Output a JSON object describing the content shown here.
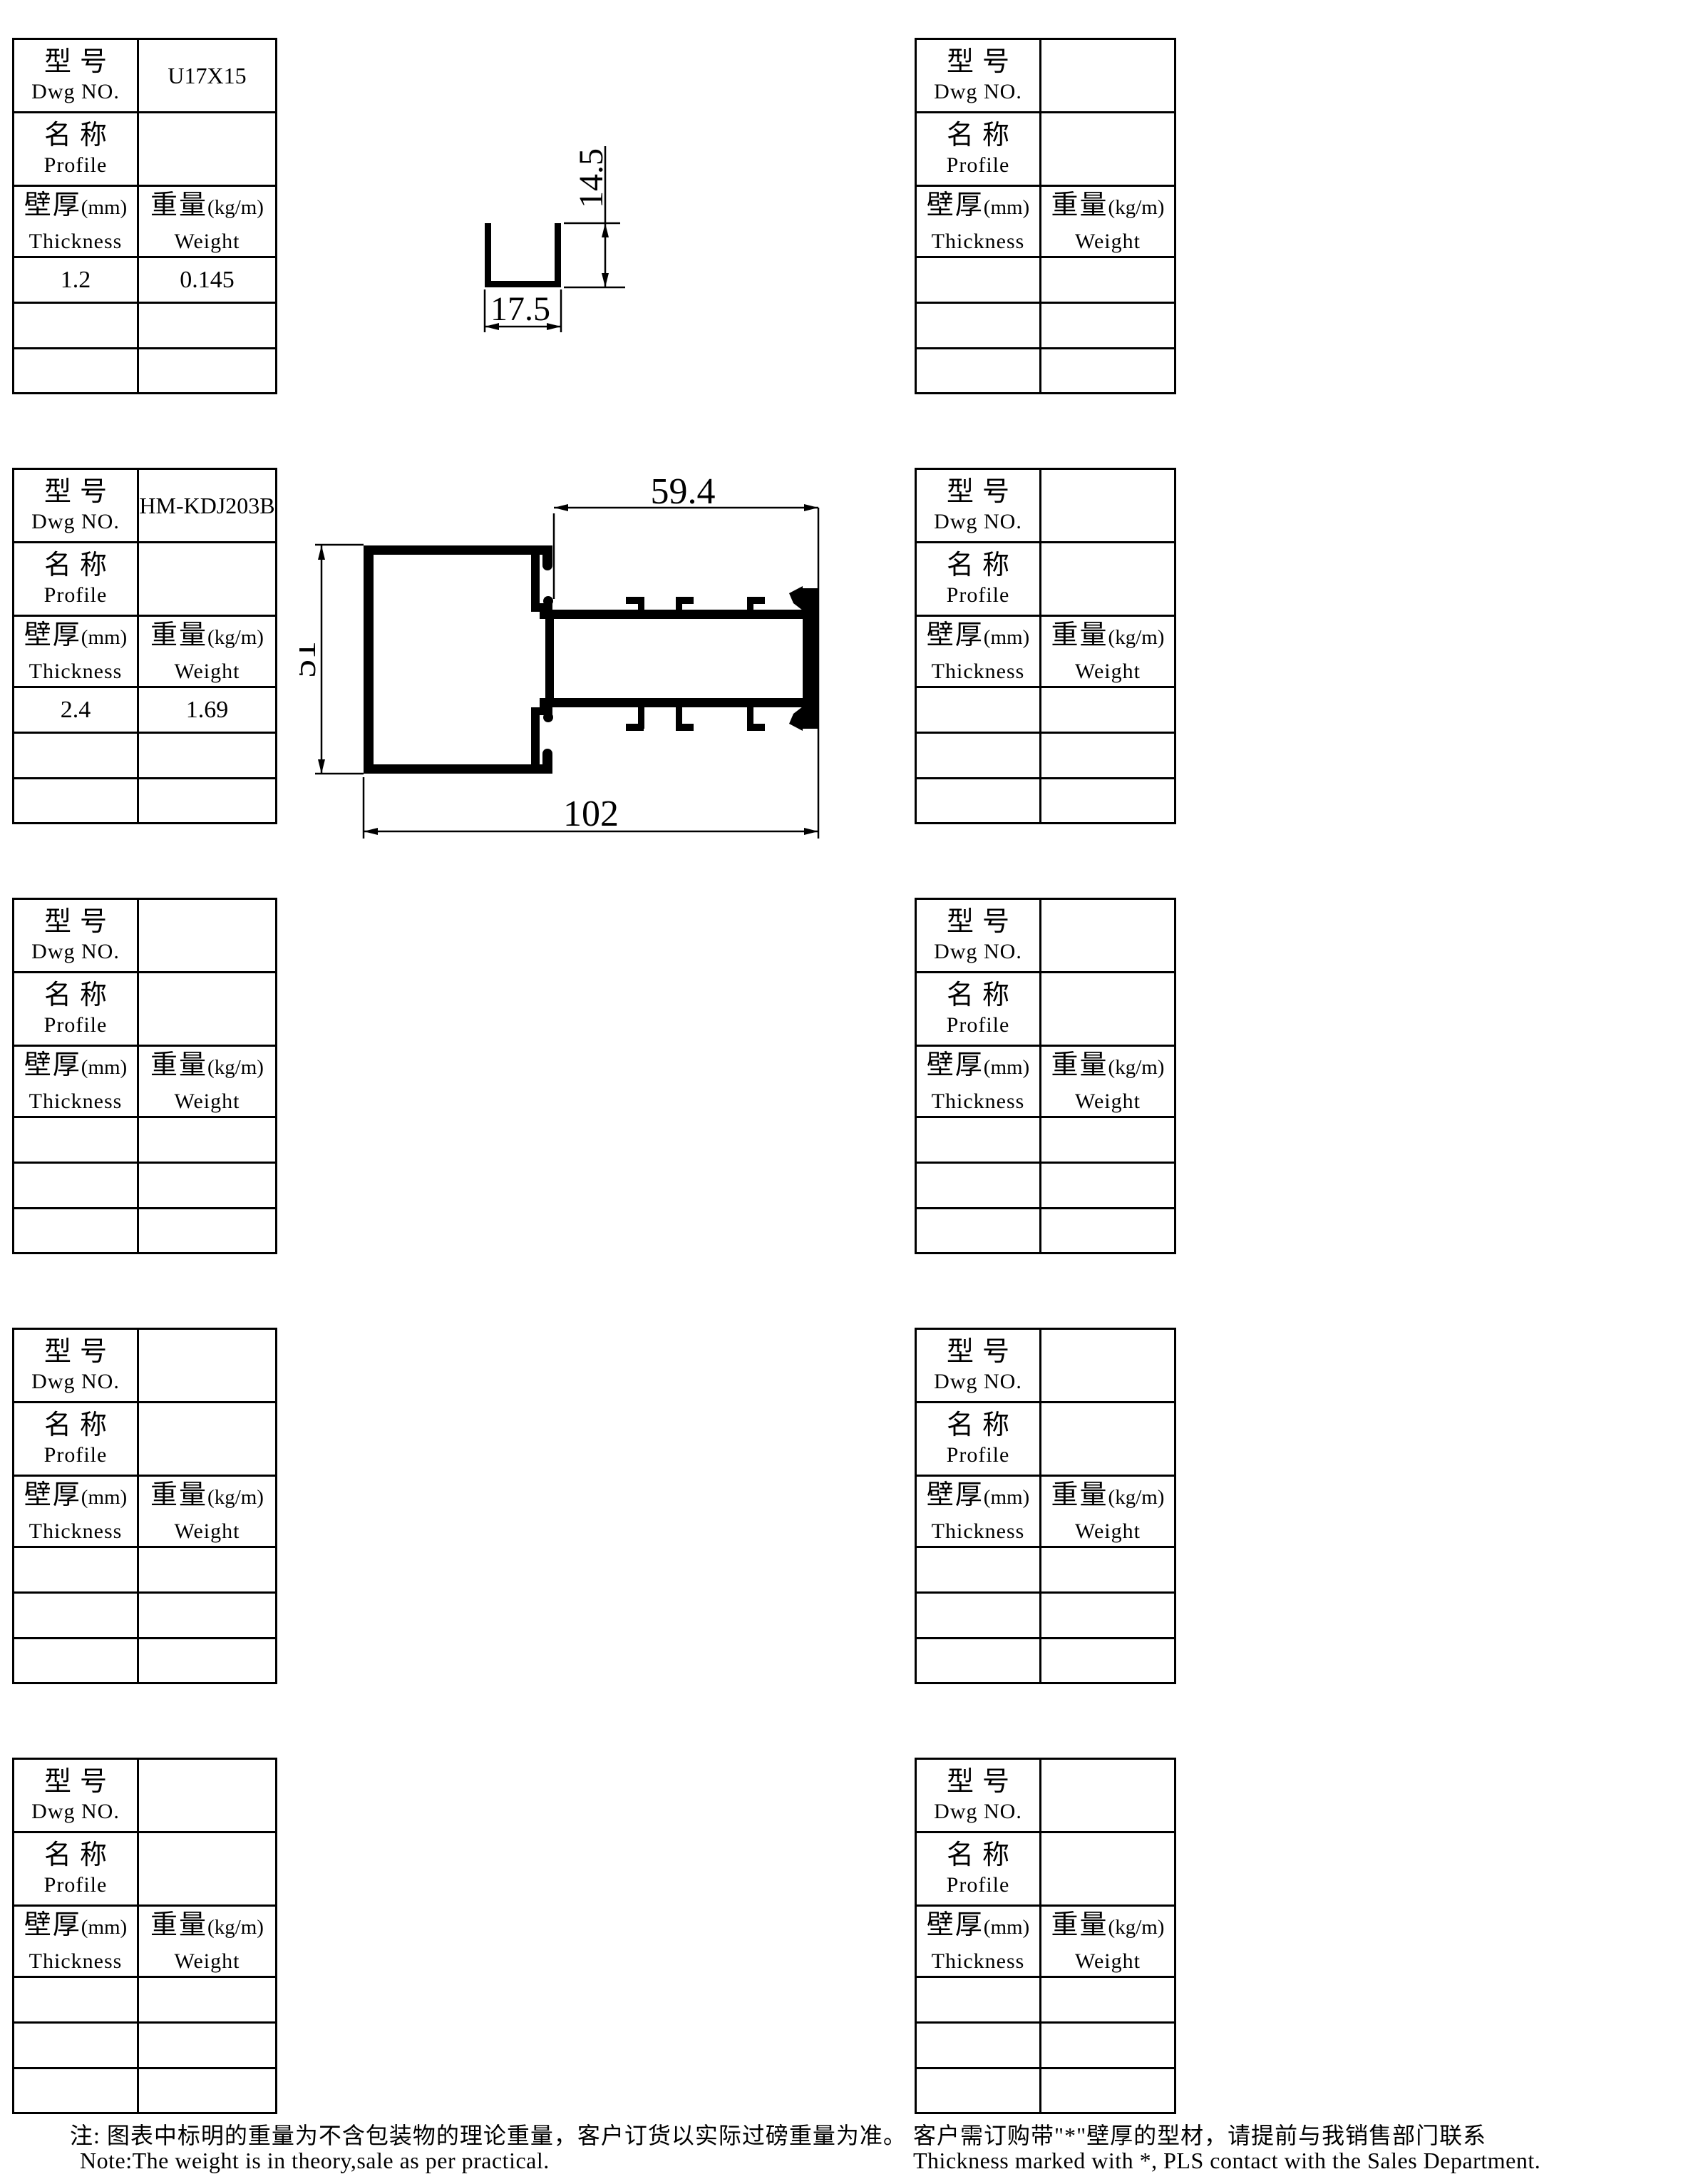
{
  "labels": {
    "dwg_cn": "型号",
    "dwg_en": "Dwg NO.",
    "profile_cn": "名称",
    "profile_en": "Profile",
    "thickness_cn": "壁厚",
    "thickness_unit": "(mm)",
    "thickness_en": "Thickness",
    "weight_cn": "重量",
    "weight_unit": "(kg/m)",
    "weight_en": "Weight"
  },
  "tables": [
    {
      "dwg_no": "U17X15",
      "profile": "",
      "values": [
        [
          "1.2",
          "0.145"
        ],
        [
          "",
          ""
        ],
        [
          "",
          ""
        ]
      ]
    },
    {
      "dwg_no": "HM-KDJ203B",
      "profile": "",
      "values": [
        [
          "2.4",
          "1.69"
        ],
        [
          "",
          ""
        ],
        [
          "",
          ""
        ]
      ]
    },
    {
      "dwg_no": "",
      "profile": "",
      "values": [
        [
          "",
          ""
        ],
        [
          "",
          ""
        ],
        [
          "",
          ""
        ]
      ]
    },
    {
      "dwg_no": "",
      "profile": "",
      "values": [
        [
          "",
          ""
        ],
        [
          "",
          ""
        ],
        [
          "",
          ""
        ]
      ]
    },
    {
      "dwg_no": "",
      "profile": "",
      "values": [
        [
          "",
          ""
        ],
        [
          "",
          ""
        ],
        [
          "",
          ""
        ]
      ]
    },
    {
      "dwg_no": "",
      "profile": "",
      "values": [
        [
          "",
          ""
        ],
        [
          "",
          ""
        ],
        [
          "",
          ""
        ]
      ]
    },
    {
      "dwg_no": "",
      "profile": "",
      "values": [
        [
          "",
          ""
        ],
        [
          "",
          ""
        ],
        [
          "",
          ""
        ]
      ]
    },
    {
      "dwg_no": "",
      "profile": "",
      "values": [
        [
          "",
          ""
        ],
        [
          "",
          ""
        ],
        [
          "",
          ""
        ]
      ]
    },
    {
      "dwg_no": "",
      "profile": "",
      "values": [
        [
          "",
          ""
        ],
        [
          "",
          ""
        ],
        [
          "",
          ""
        ]
      ]
    },
    {
      "dwg_no": "",
      "profile": "",
      "values": [
        [
          "",
          ""
        ],
        [
          "",
          ""
        ],
        [
          "",
          ""
        ]
      ]
    }
  ],
  "drawings": {
    "u_profile": {
      "dim_height": "14.5",
      "dim_width": "17.5"
    },
    "kdj_profile": {
      "dim_top": "59.4",
      "dim_side": "51",
      "dim_bottom": "102"
    }
  },
  "notes": {
    "left_cn": "注: 图表中标明的重量为不含包装物的理论重量，客户订货以实际过磅重量为准。",
    "left_en": "Note:The weight is in theory,sale as per practical.",
    "right_cn": "客户需订购带\"*\"壁厚的型材，请提前与我销售部门联系",
    "right_en": "Thickness marked with *, PLS contact with the Sales Department."
  },
  "colors": {
    "ink": "#000000",
    "paper": "#ffffff"
  }
}
